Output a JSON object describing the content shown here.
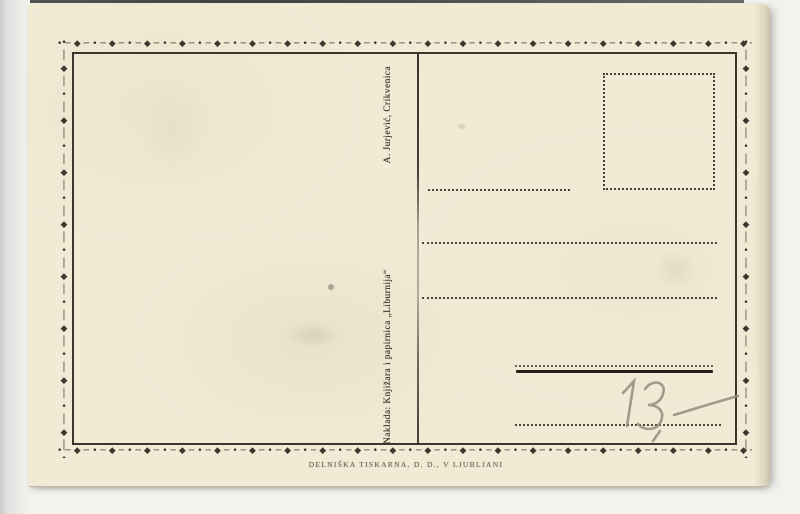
{
  "postcard": {
    "divider_imprint": {
      "publisher": "Naklada: Knjižara i papirnica „Liburnija“",
      "name": "A. Jurjević, Crikvenica"
    },
    "printer_imprint": "DELNIŠKA TISKARNA, D. D., V LJUBLJANI",
    "handwritten_price": "13,—",
    "ornament": {
      "unit_h": "•─◆─",
      "unit_v": "•│◆│"
    },
    "colors": {
      "card_paper": "#f1ebd6",
      "ink": "#2b2520",
      "faded_imprint": "#6e6554",
      "pencil": "#948c7f"
    }
  }
}
